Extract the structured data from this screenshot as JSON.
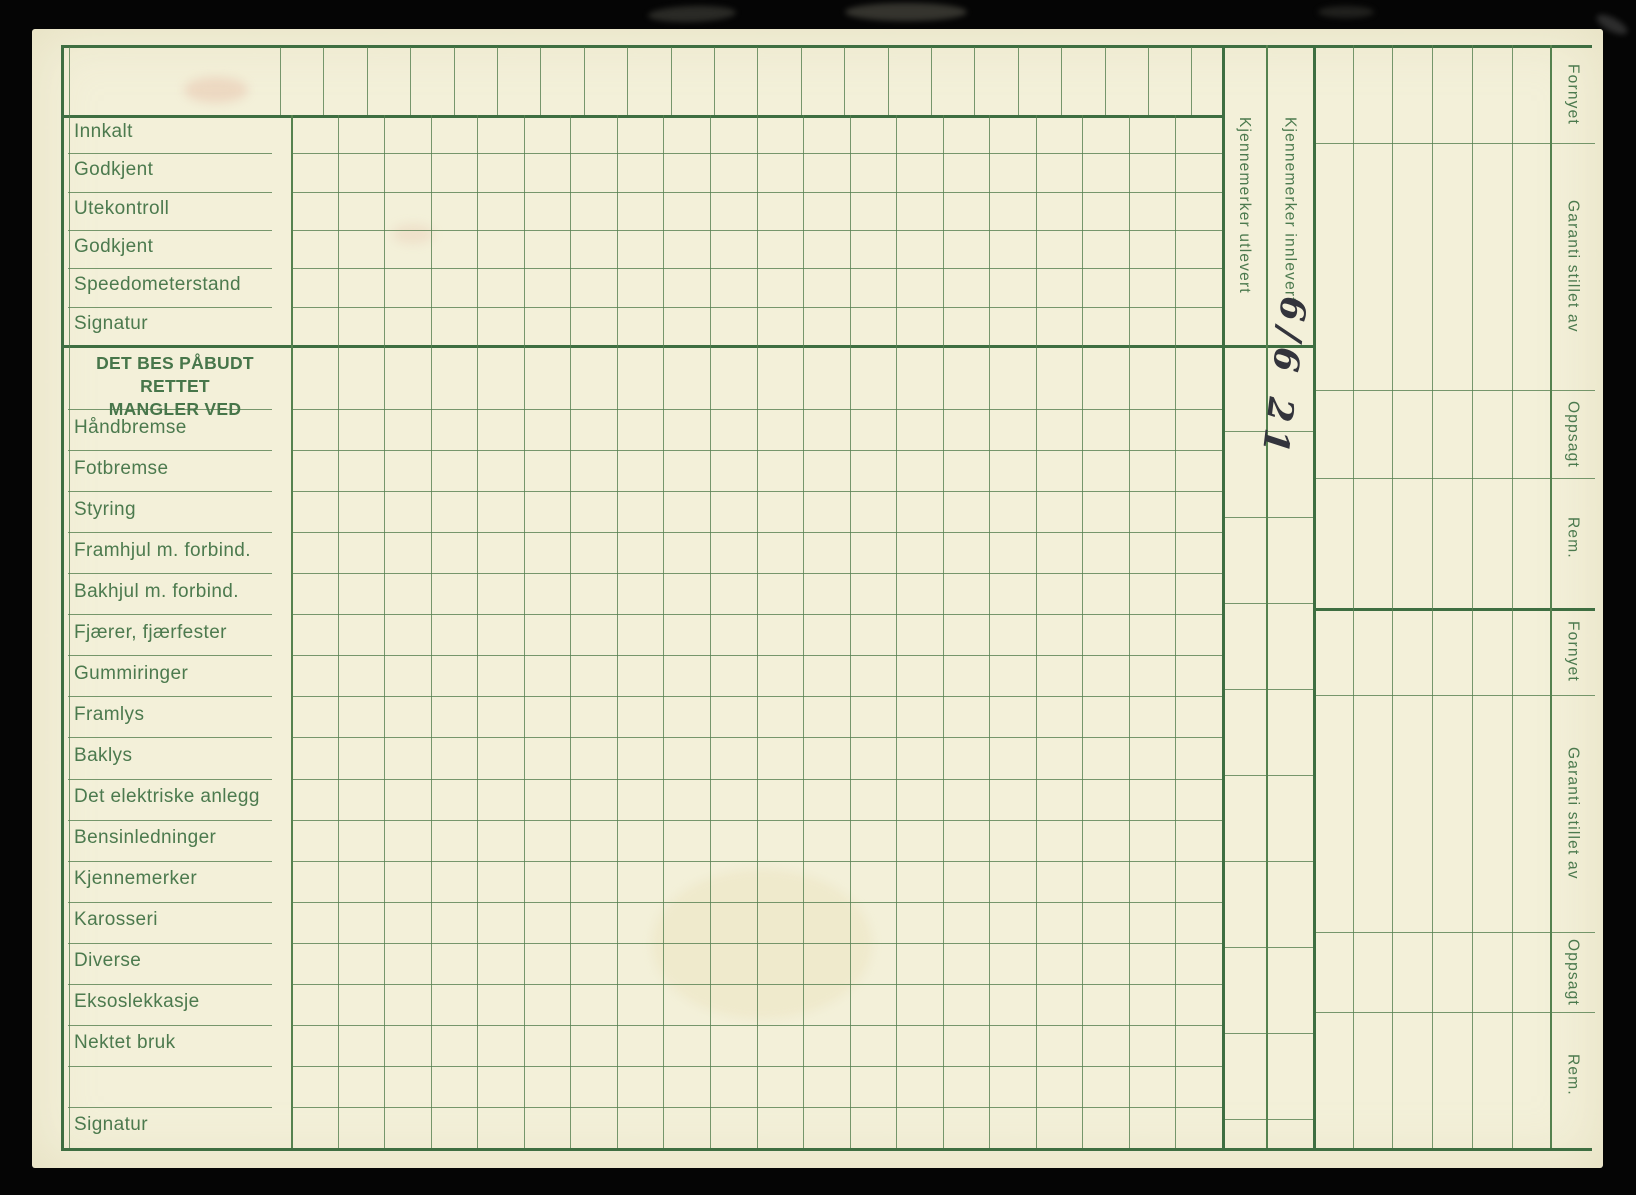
{
  "card": {
    "status_rows": [
      "Innkalt",
      "Godkjent",
      "Utekontroll",
      "Godkjent",
      "Speedometerstand",
      "Signatur"
    ],
    "section_header": {
      "line1": "DET BES PÅBUDT RETTET",
      "line2": "MANGLER VED"
    },
    "defect_rows": [
      "Håndbremse",
      "Fotbremse",
      "Styring",
      "Framhjul m. forbind.",
      "Bakhjul m. forbind.",
      "Fjærer, fjærfester",
      "Gummiringer",
      "Framlys",
      "Baklys",
      "Det elektriske anlegg",
      "Bensinledninger",
      "Kjennemerker",
      "Karosseri",
      "Diverse",
      "Eksoslekkasje",
      "Nektet bruk"
    ],
    "signature_row": "Signatur",
    "plate_columns": {
      "out": "Kjennemerker utlevert",
      "in": "Kjennemerker innlevert"
    },
    "handwriting": "6/6 21",
    "right_margin_labels": [
      "Fornyet",
      "Garanti stillet av",
      "Oppsagt",
      "Rem."
    ],
    "colors": {
      "paper": "#f3f0d9",
      "print_green": "#4c7a4e",
      "line_thin": "#5a8254",
      "line_thick": "#3e6e41",
      "ink": "#33343c",
      "background": "#050505"
    }
  }
}
